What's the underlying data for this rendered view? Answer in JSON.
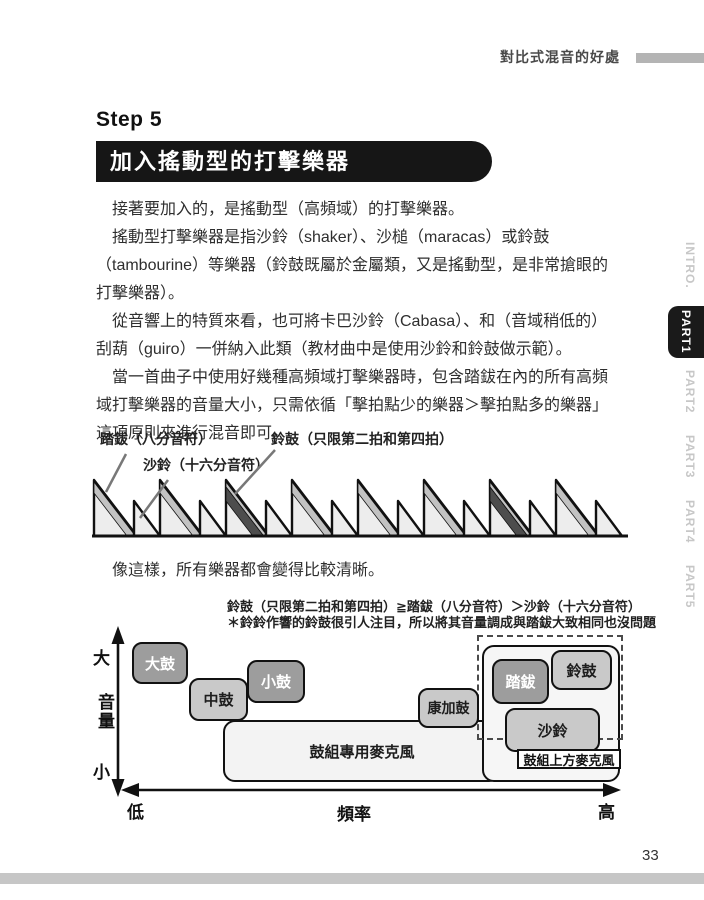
{
  "page": {
    "header_title": "對比式混音的好處",
    "page_number": "33"
  },
  "sidebar": {
    "items": [
      {
        "label": "INTRO.",
        "active": false
      },
      {
        "label": "PART1",
        "active": true
      },
      {
        "label": "PART2",
        "active": false
      },
      {
        "label": "PART3",
        "active": false
      },
      {
        "label": "PART4",
        "active": false
      },
      {
        "label": "PART5",
        "active": false
      }
    ]
  },
  "step": {
    "label": "Step 5",
    "title": "加入搖動型的打擊樂器"
  },
  "paragraphs": [
    "接著要加入的，是搖動型（高頻域）的打擊樂器。",
    "搖動型打擊樂器是指沙鈴（shaker）、沙槌（maracas）或鈴鼓（tambourine）等樂器（鈴鼓既屬於金屬類，又是搖動型，是非常搶眼的打擊樂器）。",
    "從音響上的特質來看，也可將卡巴沙鈴（Cabasa）、和（音域稍低的）刮葫（guiro）一併納入此類（教材曲中是使用沙鈴和鈴鼓做示範）。",
    "當一首曲子中使用好幾種高頻域打擊樂器時，包含踏鈸在內的所有高頻域打擊樂器的音量大小，只需依循「擊拍點少的樂器＞擊拍點多的樂器」這項原則來進行混音即可。"
  ],
  "middle_text": "像這樣，所有樂器都會變得比較清晰。",
  "waveform": {
    "label_hihat": "踏鈸（八分音符）",
    "label_shaker": "沙鈴（十六分音符）",
    "label_tambourine": "鈴鼓（只限第二拍和第四拍）",
    "units": 8,
    "accent_units": [
      3,
      7
    ]
  },
  "freq_chart": {
    "caption_line1": "鈴鼓（只限第二拍和第四拍）≧踏鈸（八分音符）＞沙鈴（十六分音符）",
    "caption_line2": "＊鈴鈴作響的鈴鼓很引人注目，所以將其音量調成與踏鈸大致相同也沒問題",
    "y_axis": {
      "top": "大",
      "label": "音量",
      "bottom": "小"
    },
    "x_axis": {
      "left": "低",
      "label": "頻率",
      "right": "高"
    },
    "boxes": {
      "kick": "大鼓",
      "tom": "中鼓",
      "snare": "小鼓",
      "conga": "康加鼓",
      "hihat": "踏鈸",
      "tambourine": "鈴鼓",
      "shaker": "沙鈴",
      "drums_mic": "鼓組專用麥克風",
      "overhead_mic": "鼓組上方麥克風"
    }
  },
  "colors": {
    "banner_bg": "#161616",
    "dark_box": "#9d9d9d",
    "light_box": "#c9c9c9",
    "band_light": "#c2c2c2",
    "band_dark": "#4d4d4d",
    "tab_active_bg": "#1a1a1a",
    "page_bar": "#c6c6c6"
  }
}
